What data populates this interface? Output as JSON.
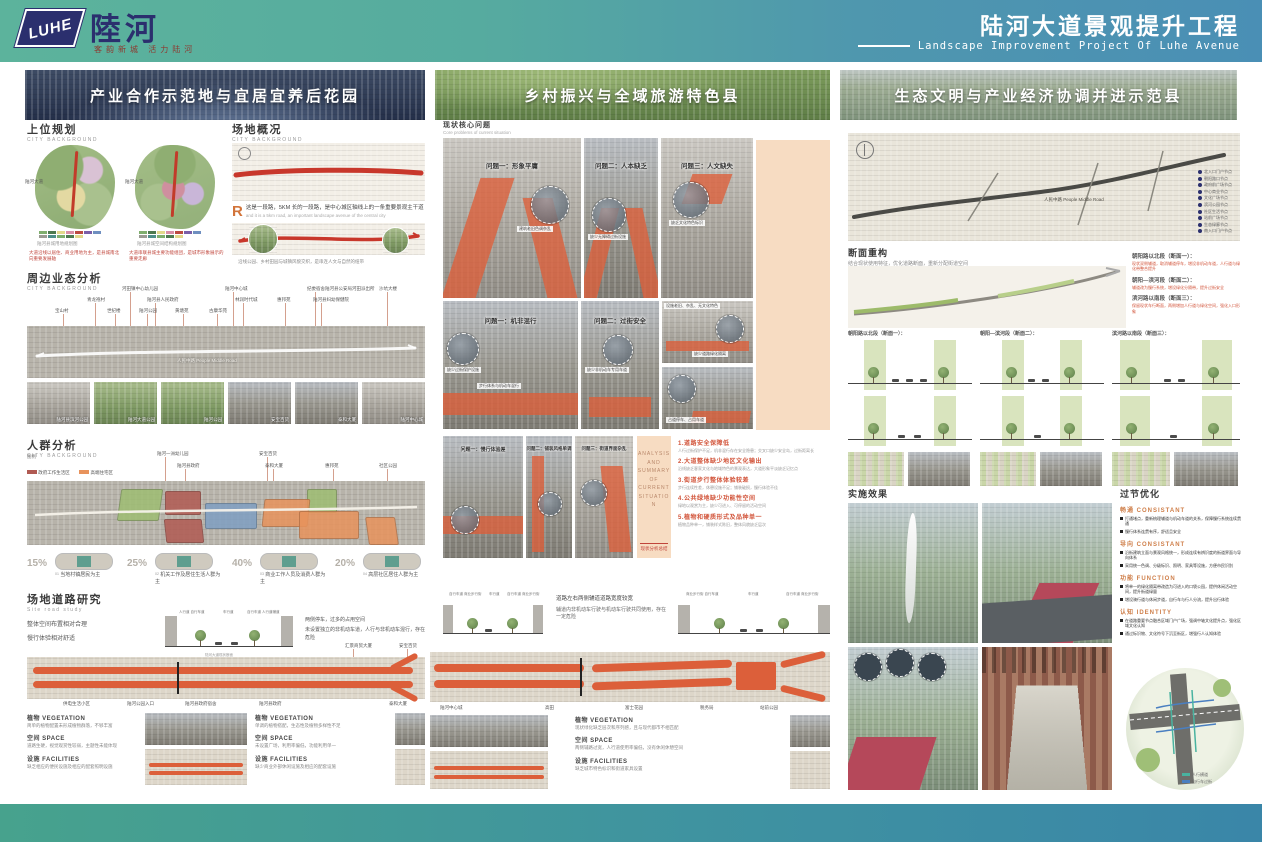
{
  "header": {
    "logo_mark": "LUHE",
    "logo_name": "陸河",
    "logo_tagline": "客韵新城 活力陆河",
    "title": "陆河大道景观提升工程",
    "subtitle": "Landscape Improvement Project Of Luhe Avenue"
  },
  "banners": [
    {
      "label": "产业合作示范地与宜居宜养后花园"
    },
    {
      "label": "乡村振兴与全域旅游特色县"
    },
    {
      "label": "生态文明与产业经济协调并进示范县"
    }
  ],
  "left": {
    "planning": {
      "title": "上位规划",
      "subtitle": "CITY BACKGROUND",
      "map1_label": "陆河大道",
      "map2_label": "陆河大道",
      "map1_caption": "陆河县城用地规划图",
      "map2_caption": "陆河县城空间结构规划图",
      "note1": "大道沿线以居住、商业用地为主，是县城南北向重要发展轴",
      "note2": "大道串联县城主要功能组团，是城市形象展示的重要走廊"
    },
    "overview": {
      "title": "场地概况",
      "subtitle": "CITY BACKGROUND",
      "drop_cap": "R",
      "note": "这是一段路，5KM 长的一段路，是中心城区轴线上的一条重要景观主干道",
      "note_en": "and it is a 5km road, an important landscape avenue of the central city",
      "caption": "沿线公园、乡村田园与城镇风貌交织，是串连人文与自然的纽带"
    },
    "business": {
      "title": "周边业态分析",
      "subtitle": "CITY BACKGROUND",
      "poi1": [
        "河田镇中心幼儿园",
        "陆河中心城",
        "纪委宿舍陆河县公安局河田派出所",
        "沙坑大楼"
      ],
      "poi2": [
        "青龙袍村",
        "陆河县人民政府",
        "林润时代城",
        "惠邦苑",
        "陆河县妇幼保健院"
      ],
      "poi3": [
        "宝山村",
        "世纪楼",
        "陆河公园",
        "黄塘苑",
        "古康华苑"
      ],
      "road_label": "人民中路 People Middle Road",
      "photos": [
        "陆河县滨河公园",
        "陆河大道公园",
        "陆河公园",
        "安宝百货",
        "泰和大厦",
        "陆河中心城"
      ]
    },
    "crowd": {
      "title": "人群分析",
      "subtitle": "CITY BACKGROUND",
      "legend_title": "图例",
      "legend": [
        {
          "label": "政府工作生活区",
          "color": "#b05a52"
        },
        {
          "label": "高端住宅区",
          "color": "#e8935c"
        },
        {
          "label": "核心商业区",
          "color": "#7f9fc2"
        },
        {
          "label": "村镇社区",
          "color": "#a3bd7a"
        }
      ],
      "labels": [
        "陆河一洲幼儿园",
        "安宝百货",
        "陆河县政府",
        "泰和大厦",
        "惠邦苑",
        "社区公园"
      ],
      "stats": [
        {
          "pct": "15%",
          "num": "01",
          "label": "当地村镇居民为主"
        },
        {
          "pct": "25%",
          "num": "02",
          "label": "机关工作及居住生活人群为主"
        },
        {
          "pct": "40%",
          "num": "03",
          "label": "商业工作人员及消费人群为主"
        },
        {
          "pct": "20%",
          "num": "04",
          "label": "高层社区居住人群为主"
        }
      ]
    },
    "road_study": {
      "title": "场地道路研究",
      "subtitle": "Site road study",
      "nl1": "整体空间布置相对合理",
      "nl2": "慢行体验相对舒适",
      "sec_labels": [
        "人行道 自行车道",
        "车行道",
        "自行车道 人行道辅道"
      ],
      "sec_caption": "陆河大道现状断面",
      "nr1": "两侧停车，过多的占用空间",
      "nr2": "未设置独立的非机动车道，人行与非机动车混行，存在危险",
      "ct": [
        "汇景商贸大厦",
        "安宝百货"
      ],
      "callouts": [
        "供电生活小区",
        "陆河公园入口",
        "陆河县政府宿舍",
        "陆河县政府",
        "泰和大厦"
      ]
    },
    "notesA": {
      "veg_t": "植物 VEGETATION",
      "veg": "简单的植物配置未形成植物群落，不够丰富",
      "space_t": "空间 SPACE",
      "space": "道路生硬，视觉观赏性较弱，主题性未能体现",
      "fac_t": "设施 FACILITIES",
      "fac": "缺乏相应的便民设施及相应的配套照明设施"
    },
    "notesB": {
      "veg_t": "植物 VEGETATION",
      "veg": "单调的植物搭配，生态性及植物多样性不足",
      "space_t": "空间 SPACE",
      "space": "未设置广场，利用率偏低，功能利用单一",
      "fac_t": "设施 FACILITIES",
      "fac": "缺少商业外部休闲设施及相应的配套设施"
    }
  },
  "middle": {
    "problems": {
      "title": "现状核心问题",
      "subtitle": "Core problems of current situation",
      "r1": [
        {
          "title": "问题一：形象平庸",
          "callout": "建筑老旧色调杂乱"
        },
        {
          "title": "问题二：人本缺乏",
          "callout": "缺少无障碍过街设施"
        },
        {
          "title": "问题三：人文缺失",
          "callout": "缺乏文化特色标识"
        }
      ],
      "r2": [
        {
          "title": "问题一：机非混行",
          "c1": "缺少过街保护设施",
          "c2": "步行体系与机动车混行"
        },
        {
          "title": "问题二：过街安全",
          "c1": "缺少非机动车专用车道"
        }
      ],
      "side": [
        "设施老旧、杂乱、无文化特色",
        "缺少道路绿化隔离",
        "占道停车、占用车道"
      ],
      "r3": [
        {
          "title": "问题一：慢行体验差"
        },
        {
          "title": "问题二：铺装风格单调"
        },
        {
          "title": "问题三：街道界面杂乱"
        }
      ]
    },
    "summary": {
      "band_en": "ANALYSIS AND SUMMARY OF CURRENT SITUATION",
      "band_cn": "现状分析总结",
      "items": [
        {
          "head": "1.道路安全保障低",
          "body": "人行过街保护不足，机非混行存在安全隐患；交叉口缺少安全岛，过街距离长"
        },
        {
          "head": "2.大道整体缺少地区文化输出",
          "body": "沿线缺乏客家文化与地域特色的景观表达，大道形象平淡缺乏记忆点"
        },
        {
          "head": "3.街道步行整体体验较差",
          "body": "步行连续性差，休憩设施不足；铺装破损，慢行体验不佳"
        },
        {
          "head": "4.公共绿地缺少功能性空间",
          "body": "绿地以观赏为主，缺少可进入、可停留的活动空间"
        },
        {
          "head": "5.植物和硬质形式及品种单一",
          "body": "植物品种单一，铺装样式陈旧，整体风貌缺乏层次"
        }
      ]
    },
    "sections": {
      "lab": [
        "自行车道 商业步行街",
        "车行道",
        "自行车道 商业步行街"
      ],
      "note1": "道路左右两侧辅道道路宽度较宽",
      "note2": "辅道内非机动车行驶与机动车行驶共同使用，存在一定危险",
      "labr": [
        "商业步行街 自行车道",
        "车行道",
        "自行车道 商业步行街"
      ],
      "plan_labels": [
        "陆河中心城",
        "高田",
        "富士花园",
        "税务局",
        "站前公园"
      ]
    },
    "notes": {
      "veg_t": "植物 VEGETATION",
      "veg": "现状绿化缺乏层次和序列感，且与现代都市不相匹配",
      "space_t": "空间 SPACE",
      "space": "两侧辅路过宽，人行道使用率偏低，没有休闲休憩空间",
      "fac_t": "设施 FACILITIES",
      "fac": "缺乏城市特色标识和街道家具设置"
    }
  },
  "right": {
    "plan": {
      "road_label": "人民中路 People Middle Road",
      "legend": [
        "北入口门户节点",
        "朝阳路口节点",
        "政府前广场节点",
        "中心商业节点",
        "文化广场节点",
        "滨河公园节点",
        "社区生活节点",
        "站前广场节点",
        "生态绿廊节点",
        "南入口门户节点"
      ]
    },
    "rebuild": {
      "title": "断面重构",
      "subtitle": "结合现状使用特征，优化道路断面，重新分配街道空间",
      "notes": [
        {
          "head": "朝阳路以北段（断面一）：",
          "body": "现状双侧辅道，取消辅道停车，增设非机动车道，人行道与绿化带整合提升"
        },
        {
          "head": "朝阳—滨河段（断面二）：",
          "body": "辅道改为慢行系统，增设绿化分隔带，提升过街安全"
        },
        {
          "head": "滨河路以南段（断面三）：",
          "body": "保留现状车行断面，两侧增加人行道与绿化空间，强化入口形象"
        }
      ],
      "groups": [
        {
          "title": "朝阳路以北段（断面一）："
        },
        {
          "title": "朝阳—滨河段（断面二）："
        },
        {
          "title": "滨河路以南段（断面三）："
        }
      ]
    },
    "effect": {
      "title": "实施效果"
    },
    "node": {
      "title": "过节优化",
      "secs": [
        {
          "head": "畅通 CONSISTANT",
          "b1": "打通堵点，重新梳理辅道与机动车道的关系，保障慢行系统连续贯通",
          "b2": "慢行体系连贯有序，舒适且安全"
        },
        {
          "head": "导向 CONSISTANT",
          "b1": "沿街建筑立面与景观风格统一，形成连续有辨识度的街道界面与导向体系",
          "b2": "采用统一色调、分级标识、照明、家具等设施，方便市民识别"
        },
        {
          "head": "功能 FUNCTION",
          "b1": "将单一的绿化隔离带改造为可进入的口袋公园，提供休闲活动空间，提升街道绿量",
          "b2": "增设骑行道与休闲步道，自行车与行人分流，提升出行体验"
        },
        {
          "head": "认知 IDENTITY",
          "b1": "在道路重要节点融合区域门户广场，强调中轴文化提升点，强化区域文化认知",
          "b2": "通过标识物、文化符号下沉至街区，增强行人认知体验"
        }
      ],
      "legend": [
        {
          "label": "人行横道",
          "color": "#49b3a0"
        },
        {
          "label": "自行车过街",
          "color": "#4a7fc1"
        }
      ]
    }
  },
  "accents": {
    "teal": "#5cb39c",
    "blue": "#4a8fb5",
    "red": "#c23b2a",
    "salmon": "#dc5f3a",
    "peach": "#f7dcc2",
    "orange": "#cf7f4a",
    "navy": "#2b2f6e"
  }
}
